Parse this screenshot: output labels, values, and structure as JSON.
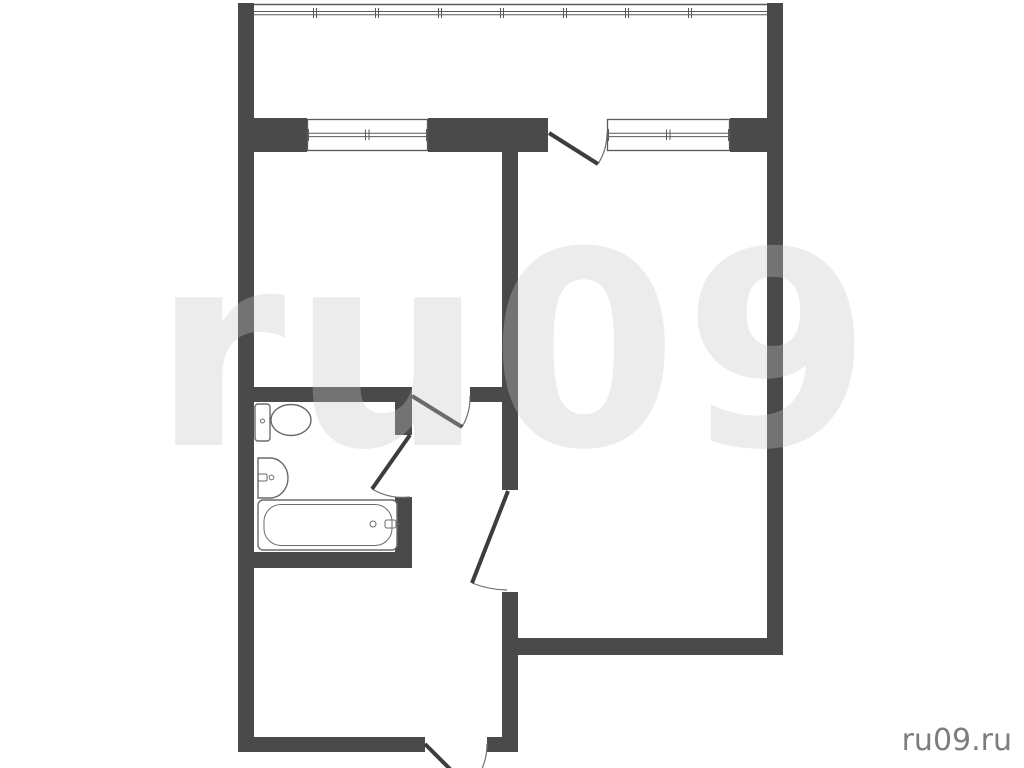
{
  "watermark": {
    "large_text": "ru09",
    "corner_text": "ru09.ru"
  },
  "colors": {
    "wall": "#4a4a4a",
    "outline": "#5a5a5a",
    "fixture_outline": "#6b6b6b",
    "door_leaf": "#3d3d3d",
    "door_arc": "#707070",
    "watermark_large": "#c8c8c8",
    "watermark_corner": "#7d7d7d",
    "watermark_corner_emboss": "#ffffff",
    "background": "#ffffff"
  },
  "plan": {
    "type": "apartment-floor-plan",
    "symbols": [
      {
        "icon": "balcony-glazing-icon",
        "count": 1
      },
      {
        "icon": "window-icon",
        "count": 2
      },
      {
        "icon": "door-swing-icon",
        "count": 5
      },
      {
        "icon": "toilet-icon",
        "count": 1
      },
      {
        "icon": "sink-icon",
        "count": 1
      },
      {
        "icon": "bathtub-icon",
        "count": 1
      }
    ]
  }
}
